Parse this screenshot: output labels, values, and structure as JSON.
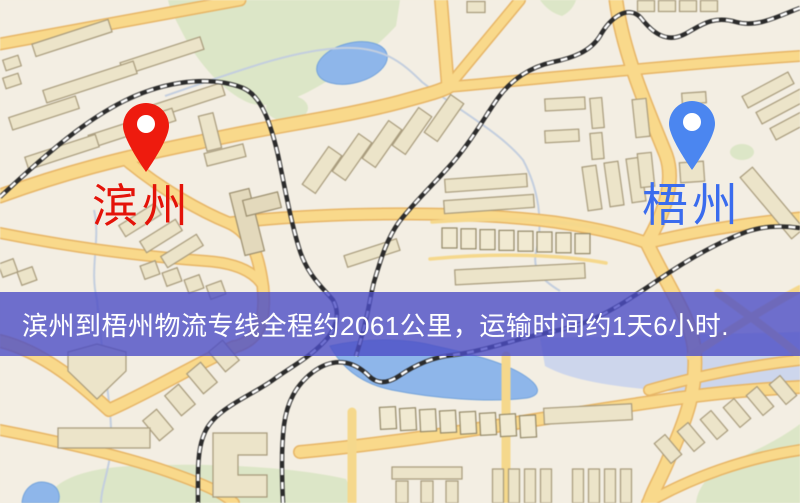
{
  "banner": {
    "text": "滨州到梧州物流专线全程约2061公里，运输时间约1天6小时.",
    "background_color": "#4c4ec6",
    "text_color": "#ffffff"
  },
  "markers": {
    "origin": {
      "label": "滨州",
      "pin_color": "#ee1b0e",
      "label_color": "#e41309"
    },
    "destination": {
      "label": "梧州",
      "pin_color": "#4b86f0",
      "label_color": "#3a6cee"
    }
  },
  "map_palette": {
    "land": "#f3eee3",
    "road_fill": "#f8d98e",
    "road_casing": "#e5b569",
    "building": "#ece4ca",
    "green_area": "#dce6c8",
    "water": "#8fb6e8",
    "railway": "#2b2b2b"
  }
}
